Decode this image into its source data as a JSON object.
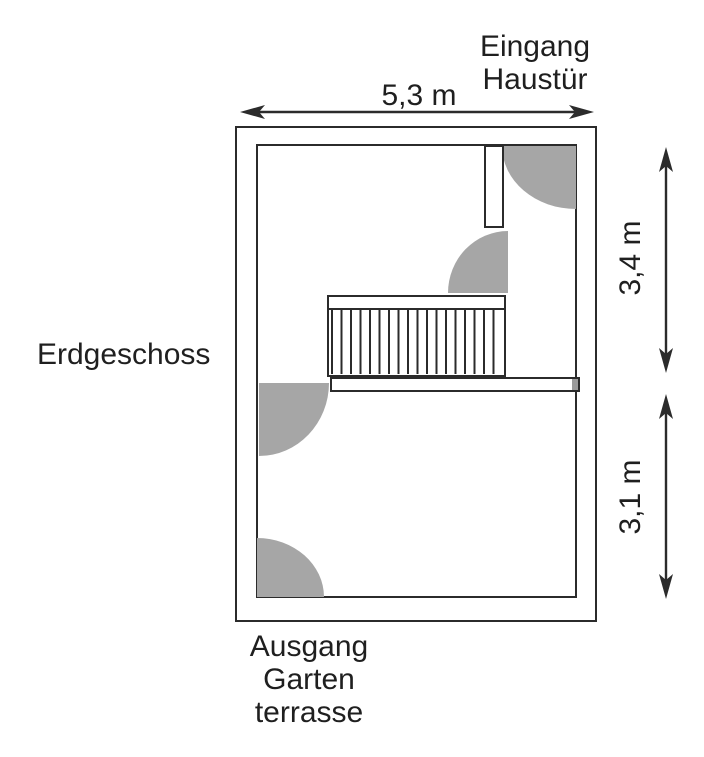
{
  "plan": {
    "floor_label": "Erdgeschoss",
    "rooms": [
      {
        "name": "Küche"
      },
      {
        "name": "Wohnzimmer"
      }
    ],
    "entrance": {
      "line1": "Eingang",
      "line2": "Haustür"
    },
    "exit": {
      "line1": "Ausgang",
      "line2": "Garten",
      "line3": "terrasse"
    },
    "dimensions": {
      "width": "5,3 m",
      "upper_height": "3,4 m",
      "lower_height": "3,1 m"
    },
    "stairs": {
      "treads": 18
    },
    "doors": {
      "swing_count": 4
    },
    "colors": {
      "door_swing_fill": "#a6a6a6",
      "wall_line": "#2b2b2b",
      "background": "#ffffff"
    }
  }
}
